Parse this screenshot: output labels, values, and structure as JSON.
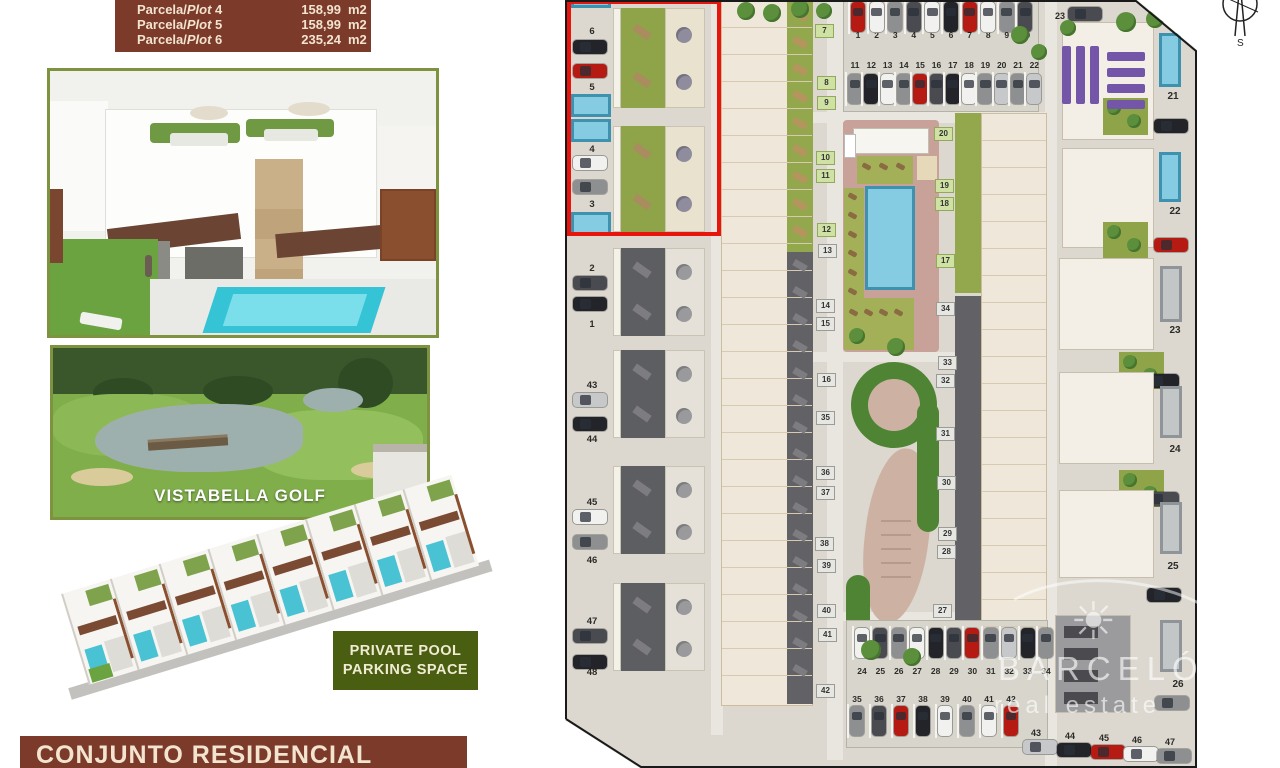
{
  "legend": {
    "rows": [
      {
        "pre": "Parcela/",
        "it": "Plot",
        "num": "4",
        "area": "158,99",
        "unit": "m2"
      },
      {
        "pre": "Parcela/",
        "it": "Plot",
        "num": "5",
        "area": "158,99",
        "unit": "m2"
      },
      {
        "pre": "Parcela/",
        "it": "Plot",
        "num": "6",
        "area": "235,24",
        "unit": "m2"
      }
    ]
  },
  "golf": {
    "label": "VISTABELLA GOLF"
  },
  "feature_box": {
    "lines": [
      "PRIVATE POOL",
      "PARKING SPACE"
    ]
  },
  "banner": {
    "text": "CONJUNTO RESIDENCIAL"
  },
  "watermark": {
    "brand": "BARCELÓ",
    "sub": "real estate",
    "sun": "☀"
  },
  "compass": {
    "n": "N",
    "s": "S",
    "e": "E",
    "w": "O"
  },
  "colors": {
    "maroon": "#7b3a2a",
    "cream": "#f2e4cf",
    "feature_green": "#4a5e11",
    "highlight_red": "#e8150d",
    "plan_bg": "#dcd8cf",
    "black": "#23242a",
    "darkgray": "#4a4b50",
    "gray": "#8d8f91",
    "silver": "#c7c8ca",
    "white": "#f1f1ef",
    "red": "#b51b12",
    "pool_blue": "#85cbe1",
    "garden_green": "#93a74d",
    "garden_gray": "#626266",
    "purple": "#7456a8",
    "park_green": "#4e8434",
    "path_pink": "#cdb2a4"
  },
  "siteplan": {
    "left_plots": [
      {
        "n": "6",
        "ny": 26,
        "cy": 40,
        "cc": "black"
      },
      {
        "n": "5",
        "ny": 82,
        "cy": 64,
        "cc": "red"
      },
      {
        "n": "4",
        "ny": 144,
        "cy": 156,
        "cc": "white"
      },
      {
        "n": "3",
        "ny": 199,
        "cy": 180,
        "cc": "gray"
      },
      {
        "n": "2",
        "ny": 263,
        "cy": 276,
        "cc": "darkgray"
      },
      {
        "n": "1",
        "ny": 319,
        "cy": 297,
        "cc": "black"
      },
      {
        "n": "43",
        "ny": 380,
        "cy": 393,
        "cc": "silver"
      },
      {
        "n": "44",
        "ny": 434,
        "cy": 417,
        "cc": "black"
      },
      {
        "n": "45",
        "ny": 497,
        "cy": 510,
        "cc": "white"
      },
      {
        "n": "46",
        "ny": 555,
        "cy": 535,
        "cc": "gray"
      },
      {
        "n": "47",
        "ny": 616,
        "cy": 629,
        "cc": "darkgray"
      },
      {
        "n": "48",
        "ny": 667,
        "cy": 655,
        "cc": "black"
      }
    ],
    "left_pools": [
      {
        "y": 0,
        "h": 8
      },
      {
        "y": 94,
        "h": 23
      },
      {
        "y": 119,
        "h": 23
      },
      {
        "y": 212,
        "h": 24
      }
    ],
    "left_blocks": [
      {
        "y": 8,
        "h": 100,
        "type": "green"
      },
      {
        "y": 126,
        "h": 106,
        "type": "green"
      },
      {
        "y": 248,
        "h": 88,
        "type": "gray"
      },
      {
        "y": 350,
        "h": 88,
        "type": "gray"
      },
      {
        "y": 466,
        "h": 88,
        "type": "gray"
      },
      {
        "y": 583,
        "h": 88,
        "type": "gray"
      }
    ],
    "mid_tags": [
      {
        "n": "7",
        "x": 250,
        "y": 24,
        "t": "g"
      },
      {
        "n": "8",
        "x": 252,
        "y": 76,
        "t": "g"
      },
      {
        "n": "9",
        "x": 252,
        "y": 96,
        "t": "g"
      },
      {
        "n": "10",
        "x": 251,
        "y": 151,
        "t": "g"
      },
      {
        "n": "11",
        "x": 251,
        "y": 169,
        "t": "g"
      },
      {
        "n": "12",
        "x": 252,
        "y": 223,
        "t": "g"
      },
      {
        "n": "13",
        "x": 253,
        "y": 244,
        "t": "w"
      },
      {
        "n": "14",
        "x": 251,
        "y": 299,
        "t": "w"
      },
      {
        "n": "15",
        "x": 251,
        "y": 317,
        "t": "w"
      },
      {
        "n": "16",
        "x": 252,
        "y": 373,
        "t": "w"
      },
      {
        "n": "35",
        "x": 251,
        "y": 411,
        "t": "w"
      },
      {
        "n": "36",
        "x": 251,
        "y": 466,
        "t": "w"
      },
      {
        "n": "37",
        "x": 251,
        "y": 486,
        "t": "w"
      },
      {
        "n": "38",
        "x": 250,
        "y": 537,
        "t": "w"
      },
      {
        "n": "39",
        "x": 252,
        "y": 559,
        "t": "w"
      },
      {
        "n": "40",
        "x": 252,
        "y": 604,
        "t": "w"
      },
      {
        "n": "41",
        "x": 253,
        "y": 628,
        "t": "w"
      },
      {
        "n": "42",
        "x": 251,
        "y": 684,
        "t": "w"
      }
    ],
    "right_mid_tags": [
      {
        "n": "20",
        "x": 369,
        "y": 127,
        "t": "g"
      },
      {
        "n": "19",
        "x": 370,
        "y": 179,
        "t": "g"
      },
      {
        "n": "18",
        "x": 370,
        "y": 197,
        "t": "g"
      },
      {
        "n": "17",
        "x": 371,
        "y": 254,
        "t": "g"
      },
      {
        "n": "34",
        "x": 371,
        "y": 302,
        "t": "w"
      },
      {
        "n": "33",
        "x": 373,
        "y": 356,
        "t": "w"
      },
      {
        "n": "32",
        "x": 371,
        "y": 374,
        "t": "w"
      },
      {
        "n": "31",
        "x": 371,
        "y": 427,
        "t": "w"
      },
      {
        "n": "30",
        "x": 372,
        "y": 476,
        "t": "w"
      },
      {
        "n": "29",
        "x": 373,
        "y": 527,
        "t": "w"
      },
      {
        "n": "28",
        "x": 372,
        "y": 545,
        "t": "w"
      },
      {
        "n": "27",
        "x": 368,
        "y": 604,
        "t": "w"
      }
    ],
    "right_tags": [
      {
        "n": "21",
        "x": 599,
        "y": 91
      },
      {
        "n": "22",
        "x": 601,
        "y": 206
      },
      {
        "n": "23",
        "x": 601,
        "y": 325
      },
      {
        "n": "24",
        "x": 601,
        "y": 444
      },
      {
        "n": "25",
        "x": 599,
        "y": 561
      },
      {
        "n": "26",
        "x": 604,
        "y": 679
      }
    ],
    "top_parking": {
      "rowA": {
        "labels": [
          "1",
          "2",
          "3",
          "4",
          "5",
          "6",
          "7",
          "8",
          "9",
          "10"
        ],
        "colors": [
          "red",
          "white",
          "gray",
          "darkgray",
          "white",
          "black",
          "red",
          "white",
          "gray",
          "darkgray"
        ],
        "x0": 286,
        "dx": 18.6,
        "numY": 30,
        "carY": 2
      },
      "rowB": {
        "labels": [
          "11",
          "12",
          "13",
          "14",
          "15",
          "16",
          "17",
          "18",
          "19",
          "20",
          "21",
          "22"
        ],
        "colors": [
          "gray",
          "black",
          "white",
          "gray",
          "red",
          "darkgray",
          "black",
          "white",
          "gray",
          "silver",
          "gray",
          "silver"
        ],
        "x0": 283,
        "dx": 16.3,
        "numY": 60,
        "carY": 74
      },
      "spot23": {
        "label": "23",
        "x": 486,
        "y": 11,
        "car": "darkgray"
      }
    },
    "bottom_parking": {
      "rowA": {
        "labels": [
          "24",
          "25",
          "26",
          "27",
          "28",
          "29",
          "30",
          "31",
          "32",
          "33",
          "34"
        ],
        "colors": [
          "white",
          "darkgray",
          "gray",
          "white",
          "black",
          "darkgray",
          "red",
          "gray",
          "silver",
          "black",
          "gray"
        ],
        "x0": 290,
        "dx": 18.4,
        "numY": 666,
        "carY": 628
      },
      "rowB": {
        "labels": [
          "35",
          "36",
          "37",
          "38",
          "39",
          "40",
          "41",
          "42"
        ],
        "colors": [
          "gray",
          "darkgray",
          "red",
          "black",
          "white",
          "gray",
          "white",
          "red"
        ],
        "x0": 285,
        "dx": 22,
        "numY": 694,
        "carY": 706
      },
      "strip": [
        {
          "n": "43",
          "x": 462,
          "y": 728,
          "car": "silver"
        },
        {
          "n": "44",
          "x": 496,
          "y": 731,
          "car": "black"
        },
        {
          "n": "45",
          "x": 530,
          "y": 733,
          "car": "red"
        },
        {
          "n": "46",
          "x": 563,
          "y": 735,
          "car": "white"
        },
        {
          "n": "47",
          "x": 596,
          "y": 737,
          "car": "gray"
        }
      ]
    },
    "right_villas": [
      {
        "hx": 497,
        "hy": 22,
        "hw": 92,
        "hh": 118,
        "px": 594,
        "py": 33,
        "ph": 54,
        "pt": "blue",
        "gx": 538,
        "gy": 98,
        "car": "black",
        "cx": 589,
        "cyy": 119,
        "dark": false
      },
      {
        "hx": 497,
        "hy": 148,
        "hw": 92,
        "hh": 100,
        "px": 594,
        "py": 152,
        "ph": 50,
        "pt": "blue",
        "gx": 538,
        "gy": 222,
        "car": "red",
        "cx": 589,
        "cyy": 238,
        "dark": false
      },
      {
        "hx": 494,
        "hy": 258,
        "hw": 95,
        "hh": 92,
        "px": 595,
        "py": 266,
        "ph": 56,
        "pt": "gray",
        "gx": 554,
        "gy": 352,
        "car": "black",
        "cx": 580,
        "cyy": 374,
        "dark": false
      },
      {
        "hx": 494,
        "hy": 372,
        "hw": 95,
        "hh": 92,
        "px": 595,
        "py": 386,
        "ph": 52,
        "pt": "gray",
        "gx": 554,
        "gy": 470,
        "car": "darkgray",
        "cx": 580,
        "cyy": 492,
        "dark": false
      },
      {
        "hx": 494,
        "hy": 490,
        "hw": 95,
        "hh": 88,
        "px": 595,
        "py": 502,
        "ph": 52,
        "pt": "gray",
        "gx": -1,
        "gy": 0,
        "car": "black",
        "cx": 582,
        "cyy": 588,
        "dark": false
      },
      {
        "hx": 490,
        "hy": 615,
        "hw": 76,
        "hh": 98,
        "px": 595,
        "py": 620,
        "ph": 52,
        "pt": "gray",
        "gx": -1,
        "gy": 0,
        "car": "gray",
        "cx": 590,
        "cyy": 696,
        "dark": true
      }
    ],
    "purple_bars": [
      {
        "x": 497,
        "y": 46,
        "w": 9,
        "h": 58
      },
      {
        "x": 511,
        "y": 46,
        "w": 9,
        "h": 58
      },
      {
        "x": 525,
        "y": 46,
        "w": 9,
        "h": 58
      },
      {
        "x": 542,
        "y": 52,
        "w": 38,
        "h": 9
      },
      {
        "x": 542,
        "y": 68,
        "w": 38,
        "h": 9
      },
      {
        "x": 542,
        "y": 84,
        "w": 38,
        "h": 9
      },
      {
        "x": 542,
        "y": 100,
        "w": 38,
        "h": 9
      }
    ],
    "trees": [
      {
        "x": 172,
        "y": 2,
        "r": 9
      },
      {
        "x": 198,
        "y": 4,
        "r": 9
      },
      {
        "x": 226,
        "y": 0,
        "r": 9
      },
      {
        "x": 251,
        "y": 3,
        "r": 8
      },
      {
        "x": 284,
        "y": 328,
        "r": 8
      },
      {
        "x": 322,
        "y": 338,
        "r": 9
      },
      {
        "x": 446,
        "y": 26,
        "r": 9
      },
      {
        "x": 466,
        "y": 44,
        "r": 8
      },
      {
        "x": 551,
        "y": 12,
        "r": 10
      },
      {
        "x": 581,
        "y": 10,
        "r": 9
      },
      {
        "x": 495,
        "y": 20,
        "r": 8
      },
      {
        "x": 296,
        "y": 640,
        "r": 10
      },
      {
        "x": 338,
        "y": 648,
        "r": 9
      }
    ]
  },
  "strip3d": {
    "units": 8
  }
}
